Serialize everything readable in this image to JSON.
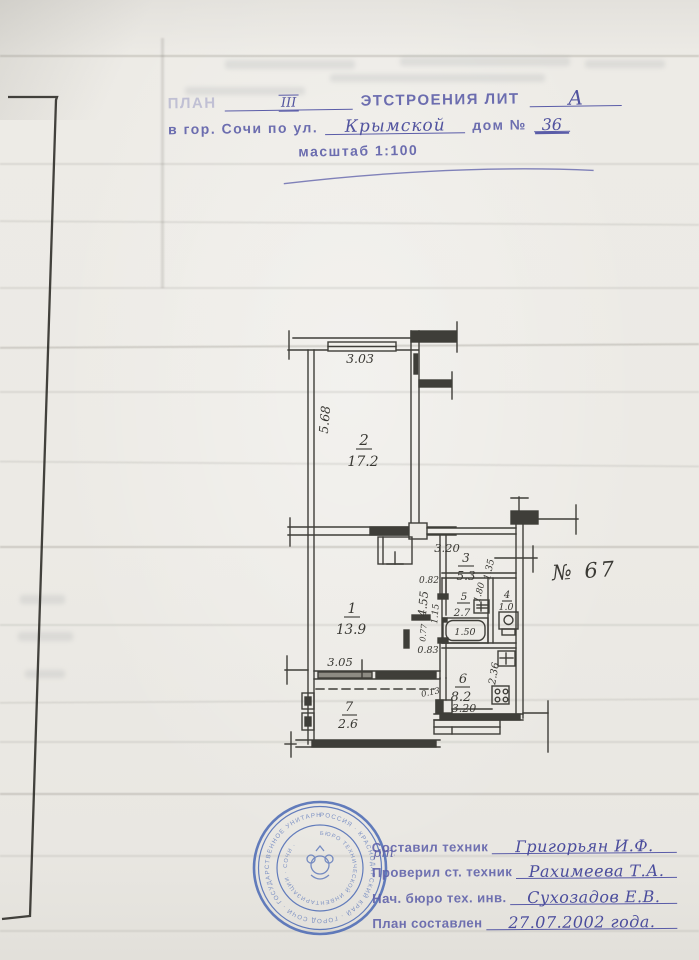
{
  "header": {
    "plan_label": "ПЛАН",
    "floor_value": "III",
    "building_label": "ЭТСТРОЕНИЯ  ЛИТ",
    "lit_value": "А",
    "address_prefix": "в гор. Сочи по ул.",
    "street_value": "Крымской",
    "house_label": "дом №",
    "house_value": "36",
    "scale_label": "масштаб 1:100"
  },
  "plan": {
    "apartment_note": "№ 67",
    "ink_color": "#3f3e39",
    "rooms": [
      {
        "num": "1",
        "area": "13.9"
      },
      {
        "num": "2",
        "area": "17.2"
      },
      {
        "num": "3",
        "area": "5.3"
      },
      {
        "num": "4",
        "area": "1.0"
      },
      {
        "num": "5",
        "area": "2.7"
      },
      {
        "num": "6",
        "area": "8.2"
      },
      {
        "num": "7",
        "area": "2.6"
      }
    ],
    "dims": {
      "room2_width": "3.03",
      "room2_height": "5.68",
      "hall_width": "3.20",
      "hall_right": "1.35",
      "corridor_len": "4.55",
      "room1_width": "3.05",
      "bath_door": "0.82",
      "bath_left": "1.15",
      "bath_right": "1.80",
      "tub_len": "1.50",
      "tub_side": "0.77",
      "tub_bottom": "0.83",
      "kitchen_depth": "2.36",
      "kitchen_width": "3.20",
      "step": "0.13"
    }
  },
  "stamp": {
    "accent_color": "#4a69b5",
    "ring_outer": "РОССИЯ · КРАСНОДАРСКИЙ КРАЙ · ГОРОД СОЧИ · ГОСУДАРСТВЕННОЕ УНИТАРНОЕ ПРЕДПРИЯТИЕ ·",
    "ring_inner": "БЮРО ТЕХНИЧЕСКОЙ ИНВЕНТАРИЗАЦИИ · СОЧИ ·",
    "overlap_note": "рти"
  },
  "footer": {
    "rows": [
      {
        "label": "Составил техник",
        "value": "Григорьян И.Ф."
      },
      {
        "label": "Проверил ст. техник",
        "value": "Рахимеева Т.А."
      },
      {
        "label": "Нач. бюро тех. инв.",
        "value": "Сухозадов Е.В."
      },
      {
        "label": "План составлен",
        "value": "27.07.2002 года."
      }
    ]
  }
}
